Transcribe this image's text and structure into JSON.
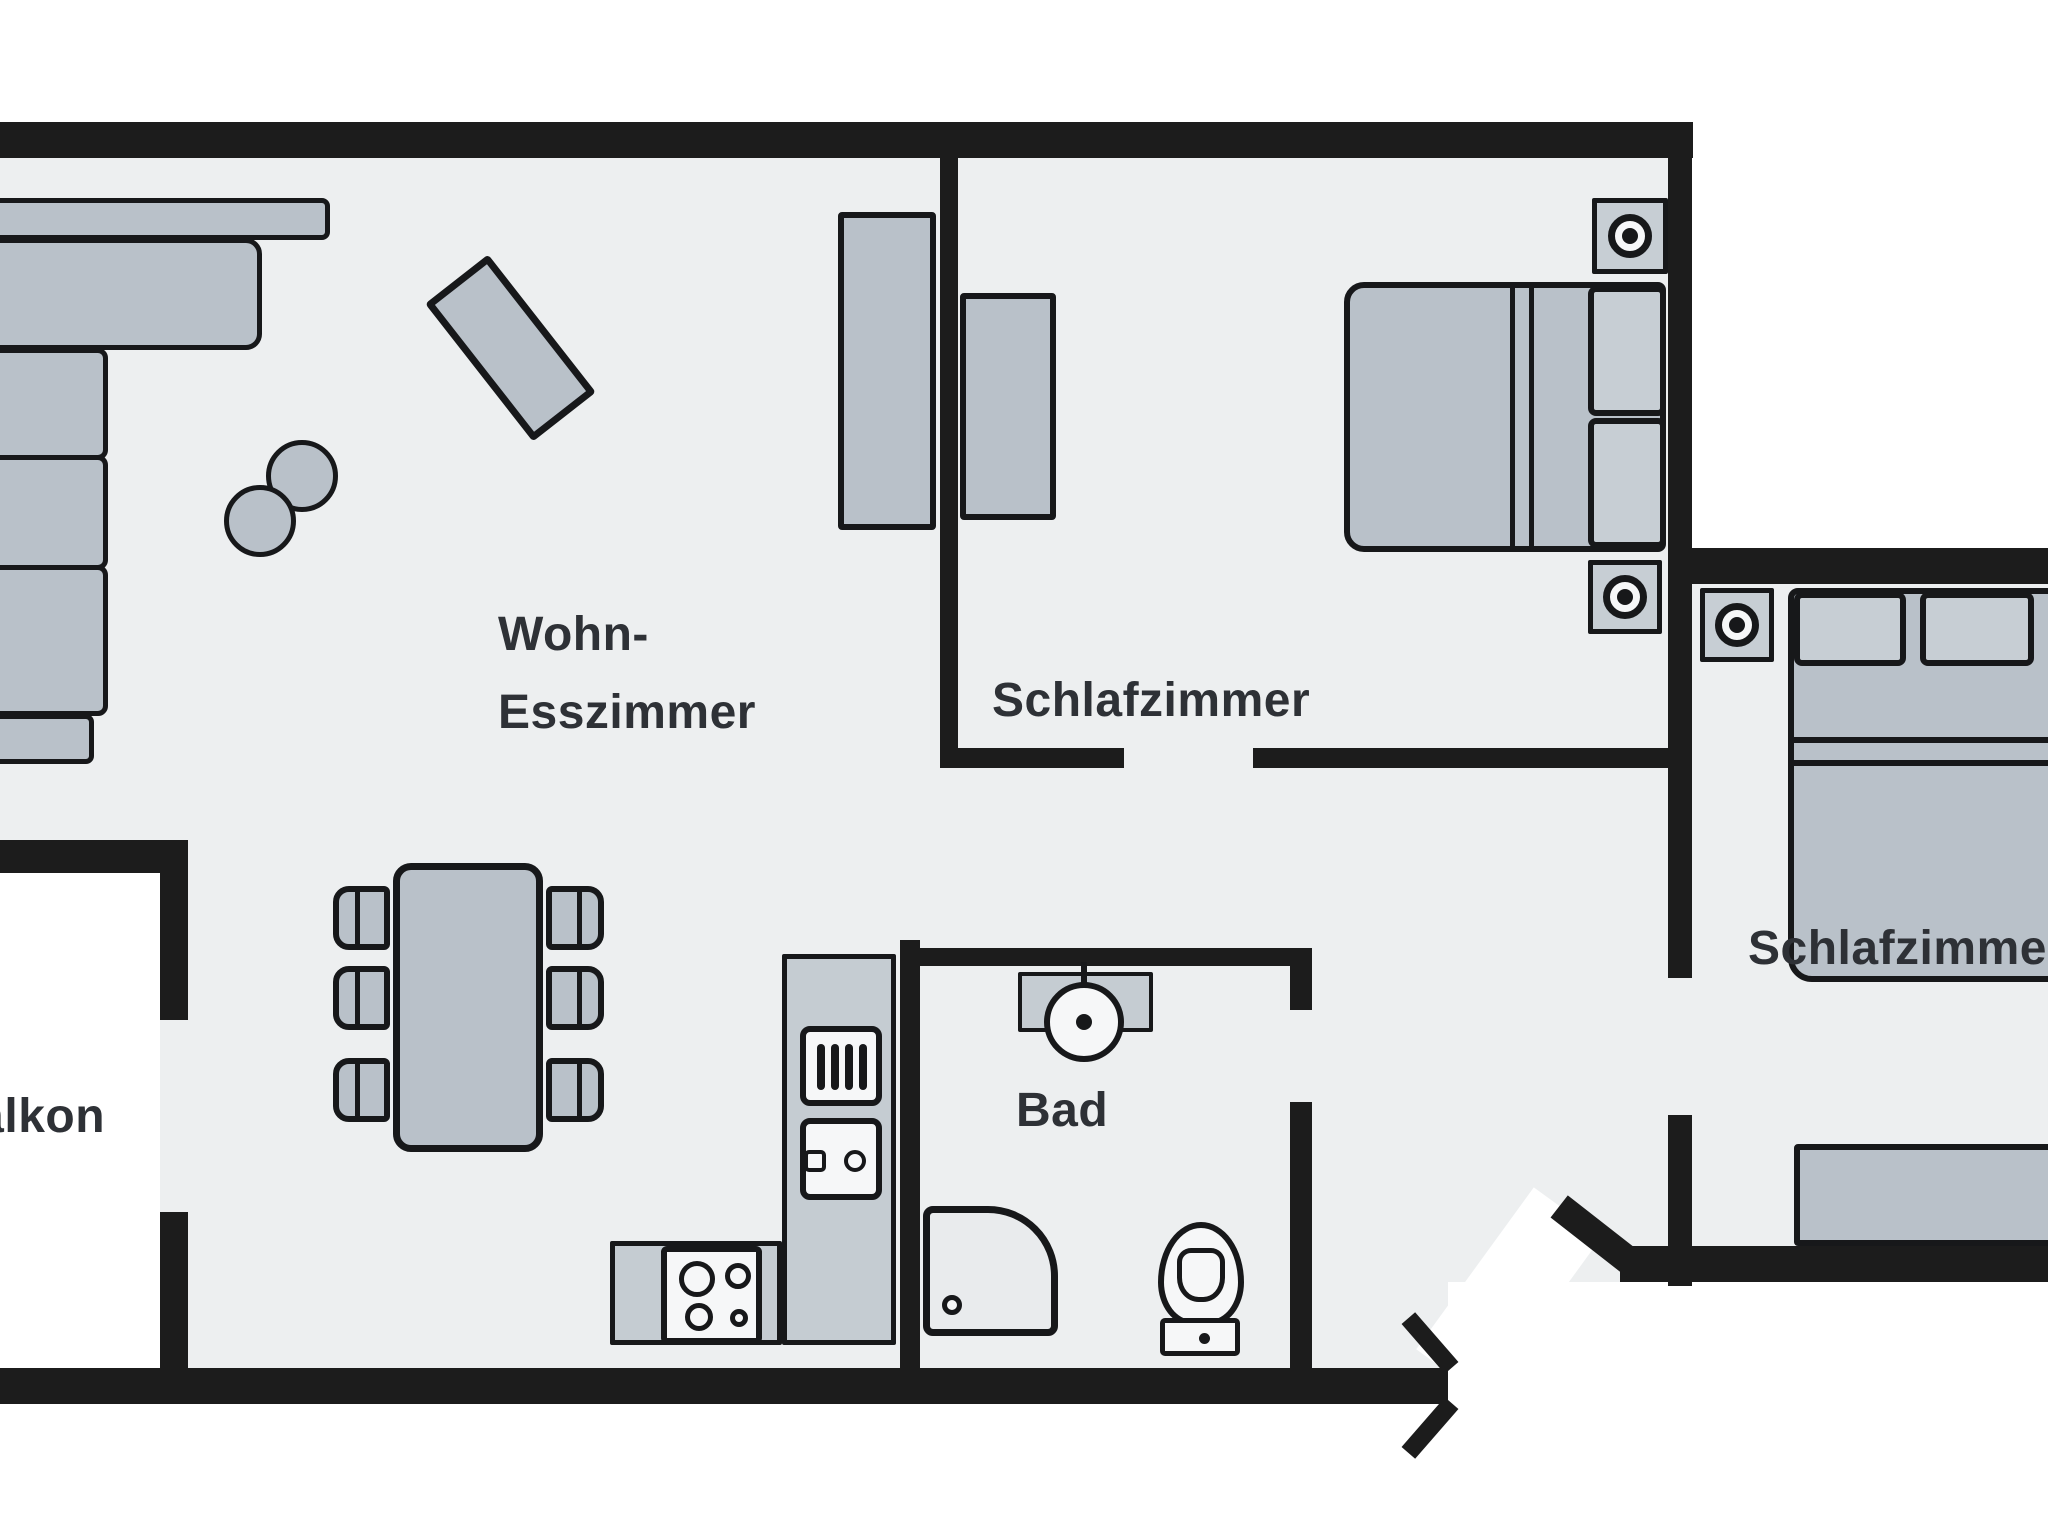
{
  "colors": {
    "wall": "#1c1c1c",
    "line": "#17181a",
    "floor": "#edeff0",
    "furniture": "#b9c1c9",
    "counter": "#c5ccd2",
    "soft": "#c7ced4",
    "fixture": "#f6f7f8",
    "shower_tray": "#e9ebed",
    "white": "#ffffff",
    "label": "#2e3136"
  },
  "rooms": {
    "living": {
      "label_line1": "Wohn-",
      "label_line2": "Esszimmer"
    },
    "bedroom1": {
      "label": "Schlafzimmer"
    },
    "bedroom2": {
      "label": "Schlafzimmer"
    },
    "bathroom": {
      "label": "Bad"
    },
    "balcony": {
      "label": "Balkon"
    }
  },
  "icons": {
    "nightstand": "bullseye-square",
    "stove": "four-burner-hob",
    "kitchen_sink": "basin-with-handle",
    "bath_sink": "round-basin-with-tap",
    "toilet": "wc-with-cistern",
    "shower": "shower-tray-with-drain",
    "appliance": "vertical-bars-unit"
  }
}
